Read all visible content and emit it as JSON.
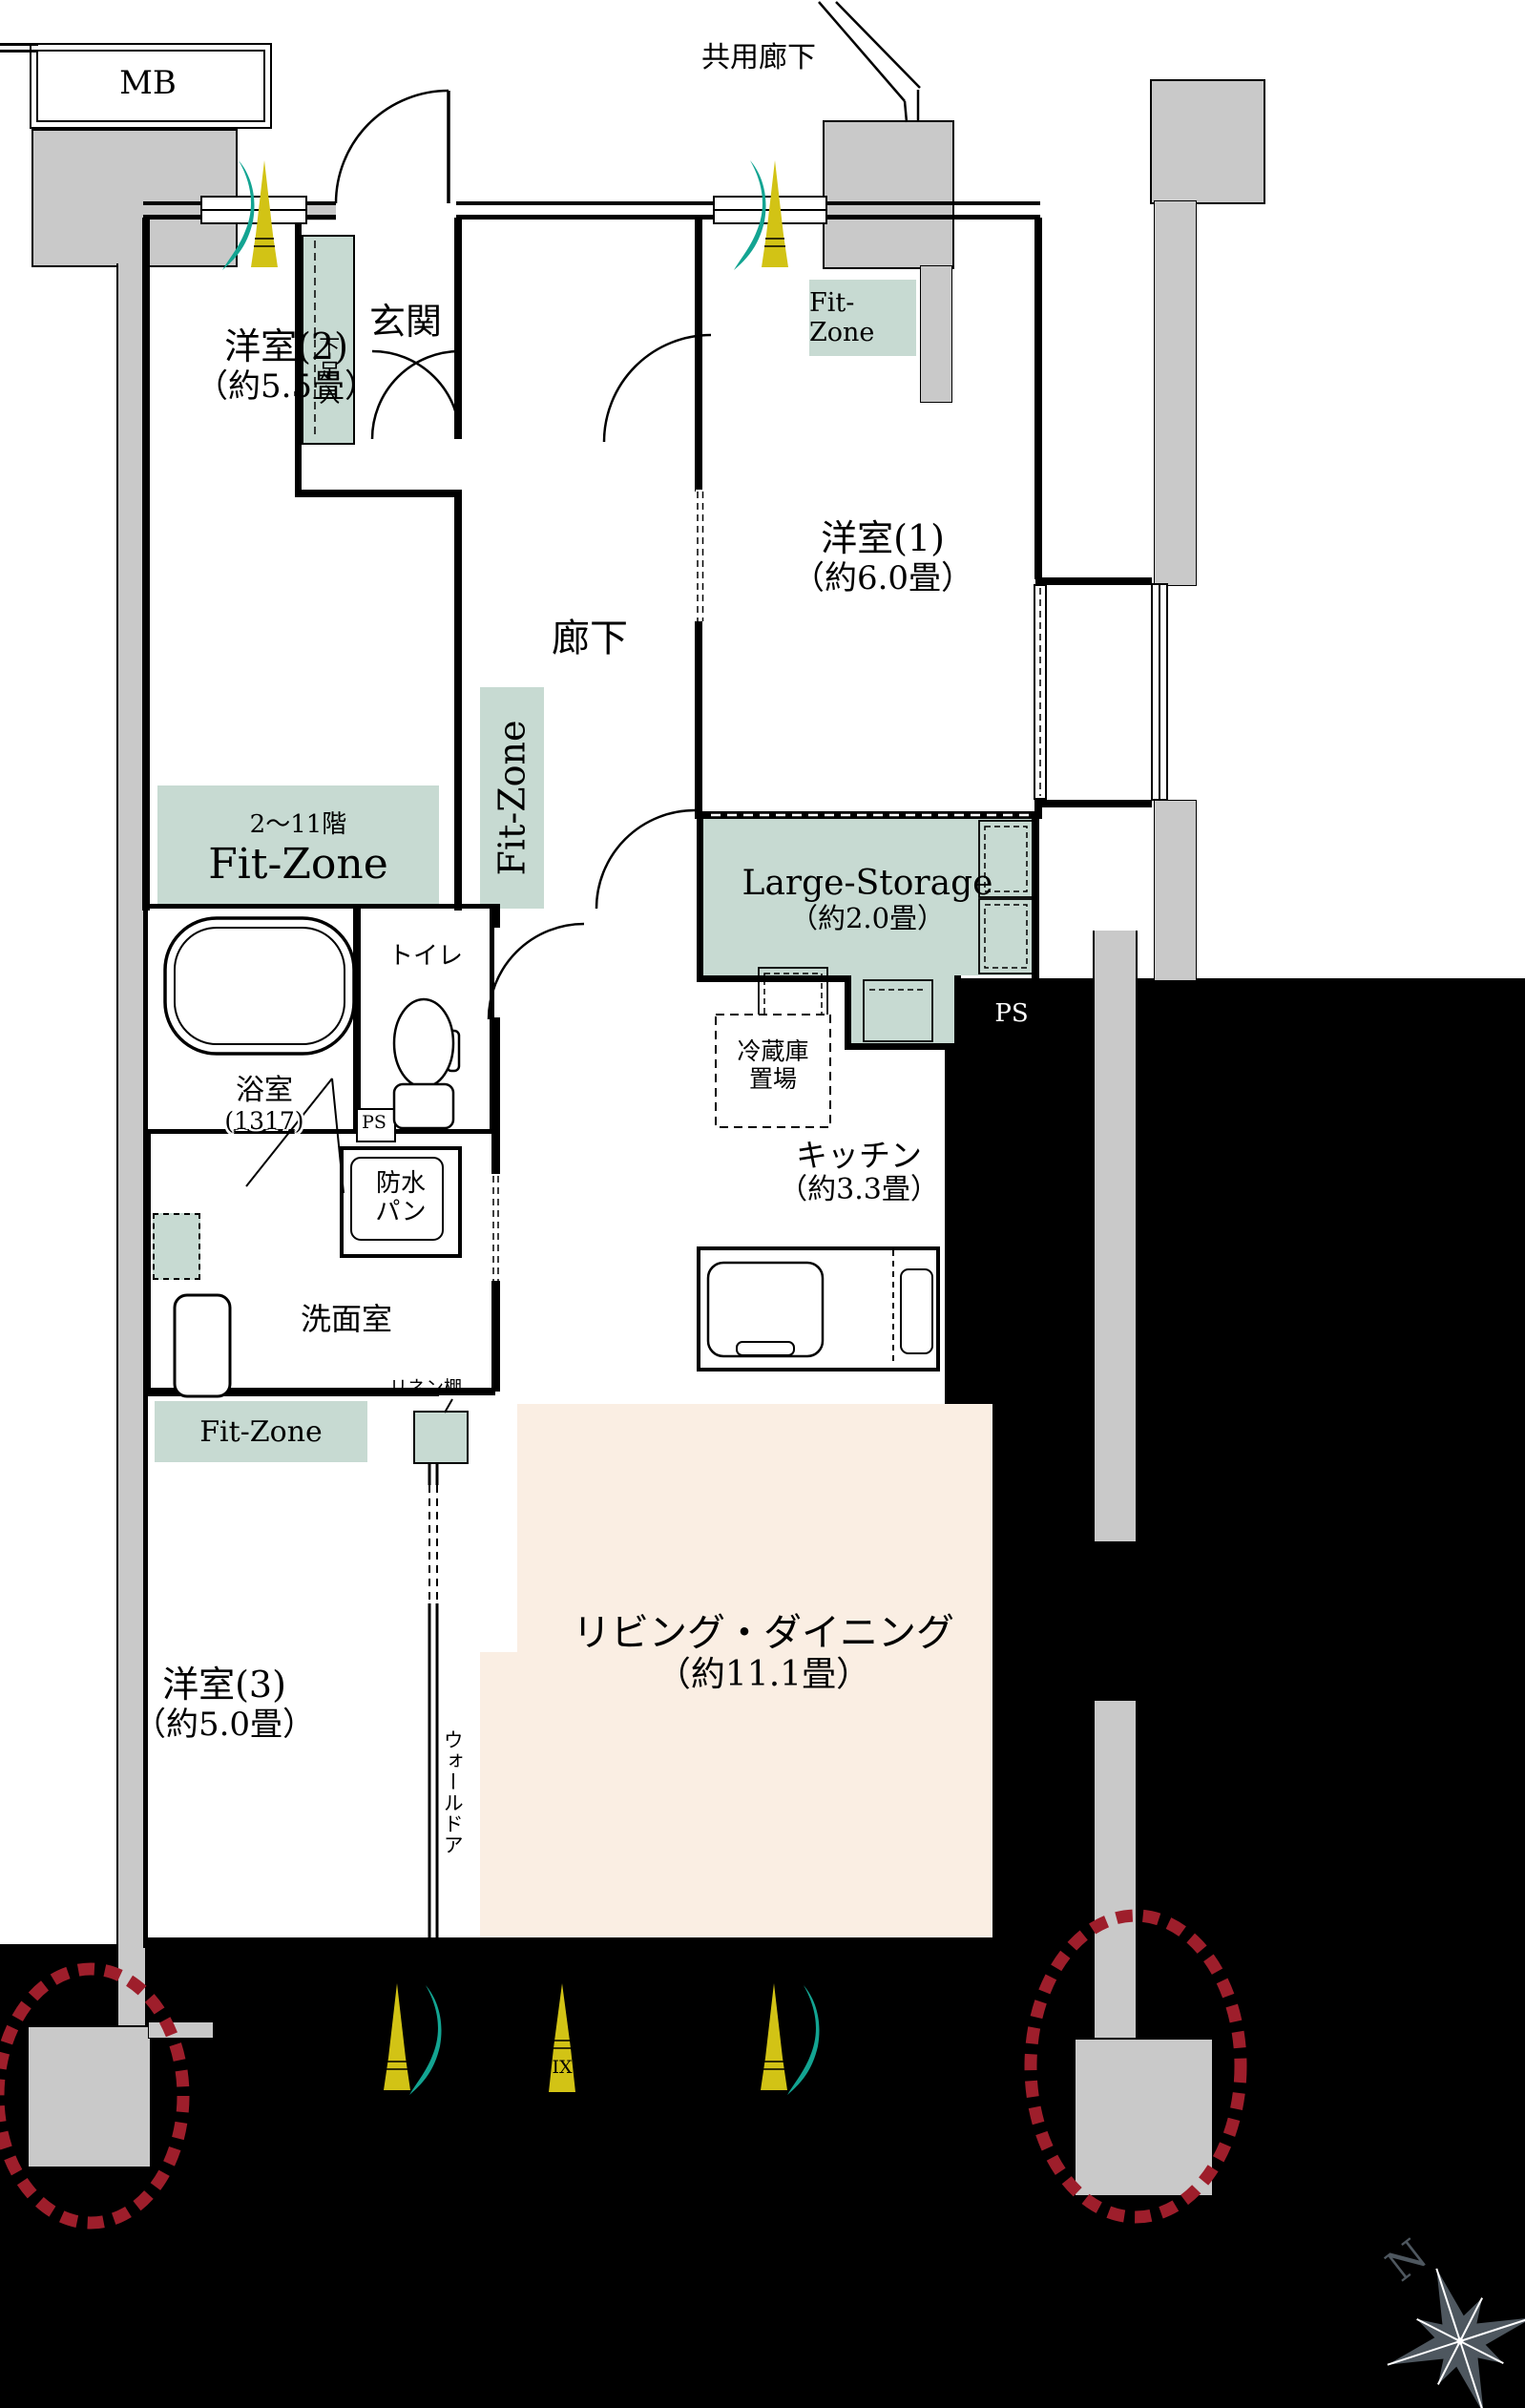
{
  "colors": {
    "teal_zone": "#c7dad2",
    "pink_ld": "#faeee3",
    "gray_fill": "#c9c9c9",
    "red_dash": "#9e1e2b",
    "yellow_arrow": "#d2c315",
    "teal_arrow": "#13a492",
    "compass": "#4e575f"
  },
  "exterior": {
    "mb": "MB",
    "common_corridor": "共用廊下",
    "north": "N"
  },
  "entrance": {
    "genkan": "玄関",
    "shoe_box": "下足入"
  },
  "corridor": {
    "label": "廊下",
    "fit_zone": "Fit-Zone"
  },
  "rooms": {
    "western1": {
      "name": "洋室(1)",
      "size": "（約6.0畳）",
      "fit_zone": "Fit-Zone"
    },
    "western2": {
      "name": "洋室(2)",
      "size": "（約5.5畳）",
      "fit_zone_floors": "2〜11階",
      "fit_zone": "Fit-Zone"
    },
    "western3": {
      "name": "洋室(3)",
      "size": "（約5.0畳）",
      "wall_door": "ウォールドア"
    },
    "living_dining": {
      "name": "リビング・ダイニング",
      "size": "（約11.1畳）"
    },
    "kitchen": {
      "name": "キッチン",
      "size": "（約3.3畳）",
      "fridge_line1": "冷蔵庫",
      "fridge_line2": "置場"
    },
    "storage": {
      "name": "Large-Storage",
      "size": "（約2.0畳）"
    },
    "bathroom": {
      "name": "浴室",
      "size": "(1317)"
    },
    "toilet": {
      "name": "トイレ"
    },
    "washroom": {
      "name": "洗面室",
      "linen": "リネン棚",
      "pan_line1": "防水",
      "pan_line2": "パン",
      "fit_zone": "Fit-Zone"
    }
  },
  "labels": {
    "ps_main": "PS",
    "ps_small": "PS",
    "ix": "IX"
  }
}
